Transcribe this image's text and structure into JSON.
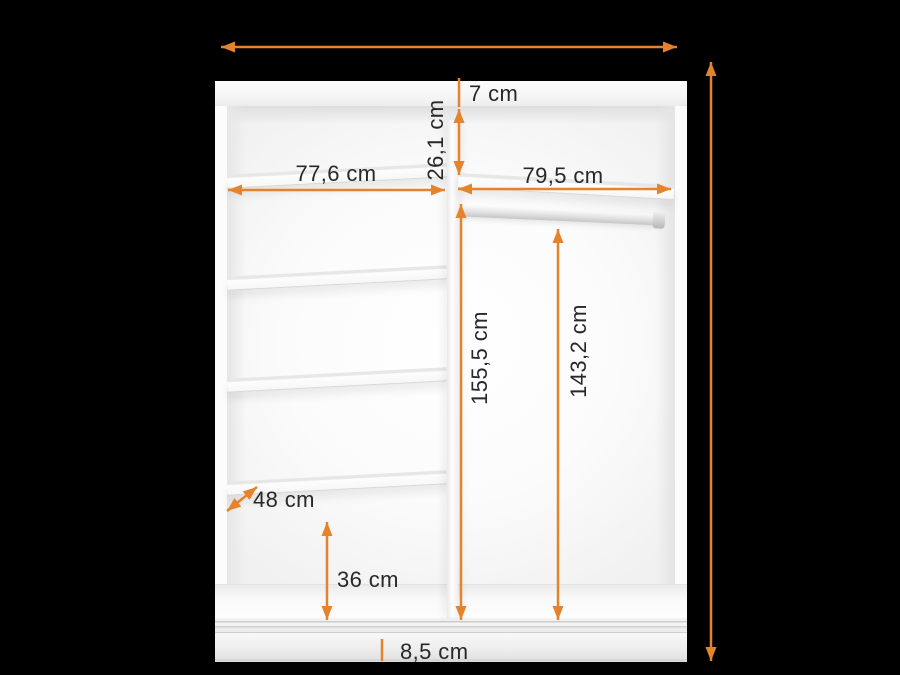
{
  "scene": {
    "description": "Wardrobe interior dimensions diagram with orange measurement arrows on black background",
    "background_color": "#000000",
    "accent_color": "#E5832D",
    "label_color": "#282828"
  },
  "dimensions": {
    "overall_width_label": "",
    "overall_height_label": "",
    "top_panel_thickness": "7 cm",
    "top_shelf_clearance": "26,1 cm",
    "left_section_width": "77,6 cm",
    "right_section_width": "79,5 cm",
    "right_section_height": "155,5 cm",
    "hanging_space_height": "143,2 cm",
    "shelf_depth": "48 cm",
    "bottom_shelf_clearance": "36 cm",
    "plinth_height": "8,5 cm"
  }
}
